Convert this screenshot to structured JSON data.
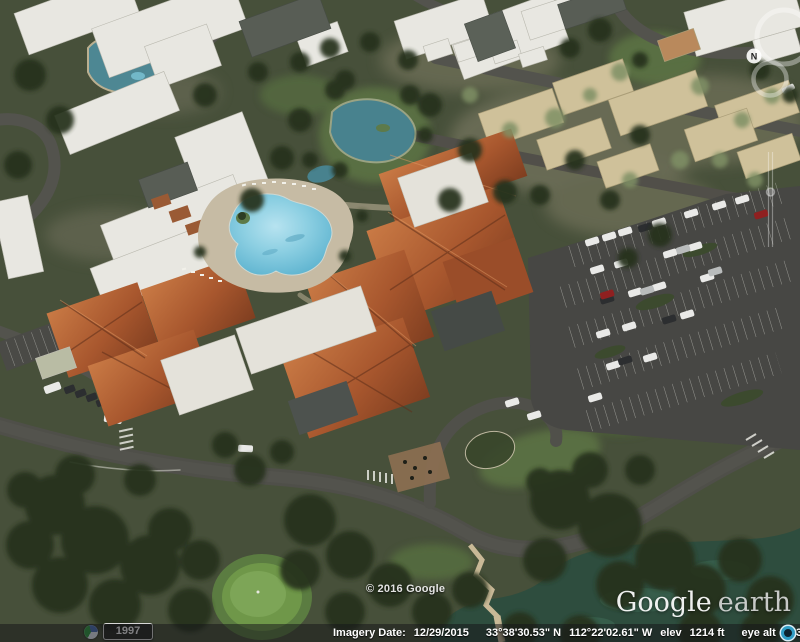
{
  "app": {
    "name": "Google Earth"
  },
  "status_bar": {
    "imagery_date_label": "Imagery Date:",
    "imagery_date": "12/29/2015",
    "latitude": "33°38'30.53\" N",
    "longitude": "112°22'02.61\" W",
    "elev_label": "elev",
    "elevation": "1214 ft",
    "eye_alt_label": "eye alt",
    "eye_altitude": "1638 ft",
    "streaming_icon": "streaming-progress-icon"
  },
  "map_overlays": {
    "copyright": "© 2016 Google",
    "watermark": {
      "google": "Google",
      "earth": "earth"
    },
    "time_slider": {
      "year": "1997",
      "icon": "historical-imagery-clock-icon"
    }
  },
  "nav_controls": {
    "north_label": "N",
    "icons": [
      "look-ring",
      "move-ring",
      "zoom-slider",
      "compass-north-badge"
    ]
  },
  "colors": {
    "status_bar_bg": "rgba(22,22,24,0.52)",
    "status_text": "#ffffff",
    "streaming_icon_ring": "#2f9cc4",
    "pool_water": "#7cc4da",
    "roof_orange": "#a8572e",
    "roof_white": "#e8e7e1",
    "roof_tan": "#cfc19a",
    "asphalt": "#50504a",
    "vegetation_dark": "#26331e",
    "golf_green": "#6f9749",
    "pond_teal": "#4d8a96",
    "lake_dark": "#2e4d3e"
  },
  "scene": {
    "description": "Oblique aerial imagery of a desert resort community: white flat-roofed buildings, a recreation center with terracotta hip roofs, a free-form swimming pool with deck, lagoon ponds, a large parking lot with rows of cars, curving roads, dense trees, a golf green and a lake."
  }
}
